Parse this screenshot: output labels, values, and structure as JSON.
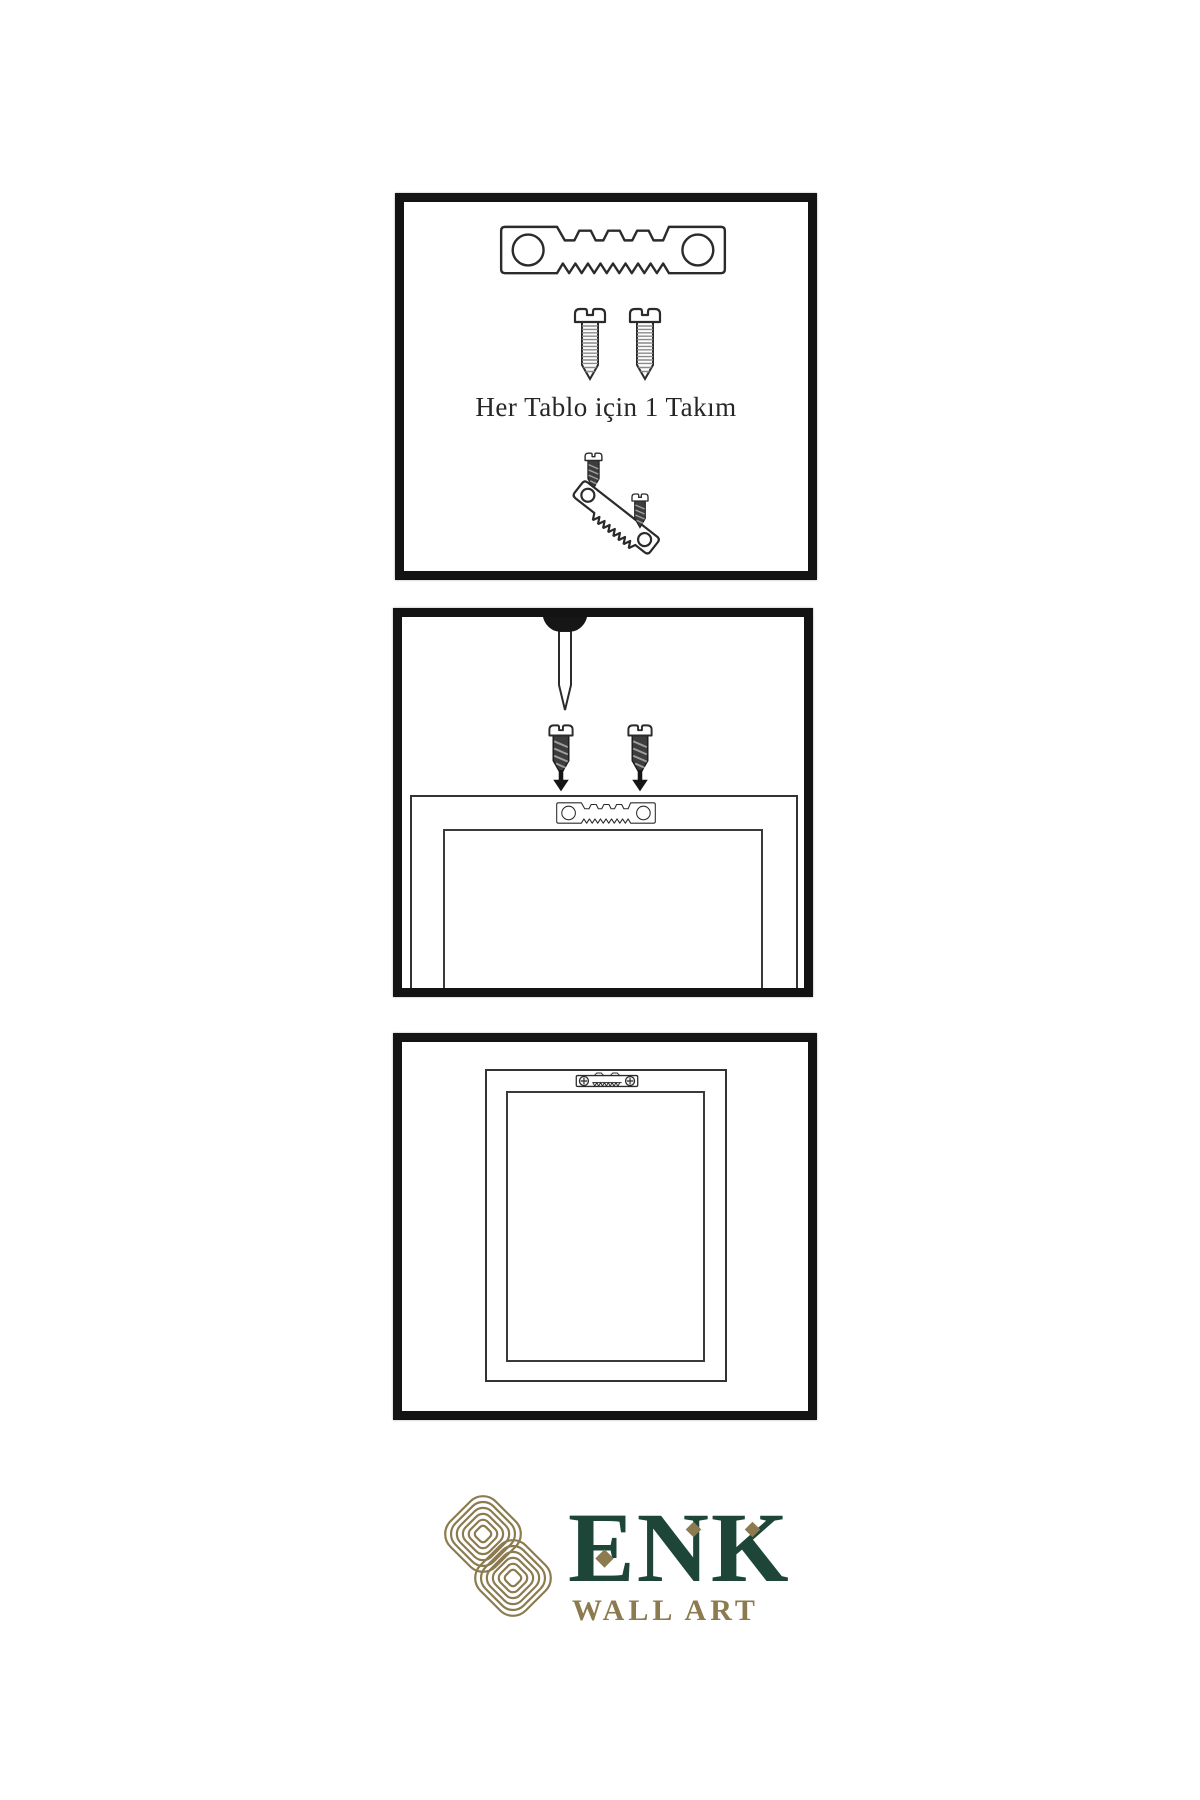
{
  "background": "#ffffff",
  "step1": {
    "caption": "Her Tablo için 1 Takım"
  },
  "brand": {
    "title": "ENK",
    "subtitle": "WALL ART",
    "green": "#1d4639",
    "gold": "#8b7b4f"
  },
  "icons": {
    "hanger": "sawtooth-hanger-icon",
    "screw": "screw-icon",
    "dark_screw": "dark-screw-icon",
    "nail": "nail-icon",
    "arrow": "arrow-down-icon",
    "installed_hanger": "installed-hanger-icon",
    "knot": "knot-logo-icon"
  }
}
